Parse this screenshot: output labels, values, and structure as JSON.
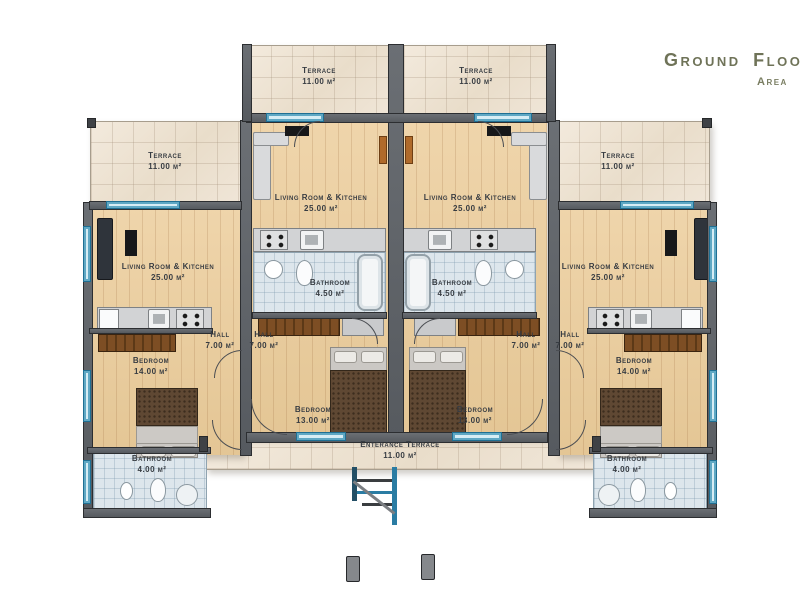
{
  "title": {
    "main": "Ground Floo",
    "sub": "Area"
  },
  "room_labels": {
    "terrace": {
      "name": "Terrace",
      "area": "11.00 m²"
    },
    "living_kitchen": {
      "name": "Living Room & Kitchen",
      "area": "25.00 m²"
    },
    "bathroom_en_suite": {
      "name": "Bathroom",
      "area": "4.50 m²"
    },
    "hall": {
      "name": "Hall",
      "area": "7.00 m²"
    },
    "bedroom_large": {
      "name": "Bedroom",
      "area": "14.00 m²"
    },
    "bedroom_small": {
      "name": "Bedroom",
      "area": "13.00 m²"
    },
    "bathroom_small": {
      "name": "Bathroom",
      "area": "4.00 m²"
    },
    "entrance_terrace": {
      "name": "Enterance Terrace",
      "area": "11.00 m²"
    }
  },
  "colors": {
    "wall": "#606468",
    "wood_floor": "#ebd0a6",
    "terrace_tile": "#efe6da",
    "bath_tile": "#dde6ec",
    "window": "#2a7ca3",
    "furniture_wood": "#7d4e24",
    "title_text": "#6f7358",
    "label_text": "#373c42"
  }
}
